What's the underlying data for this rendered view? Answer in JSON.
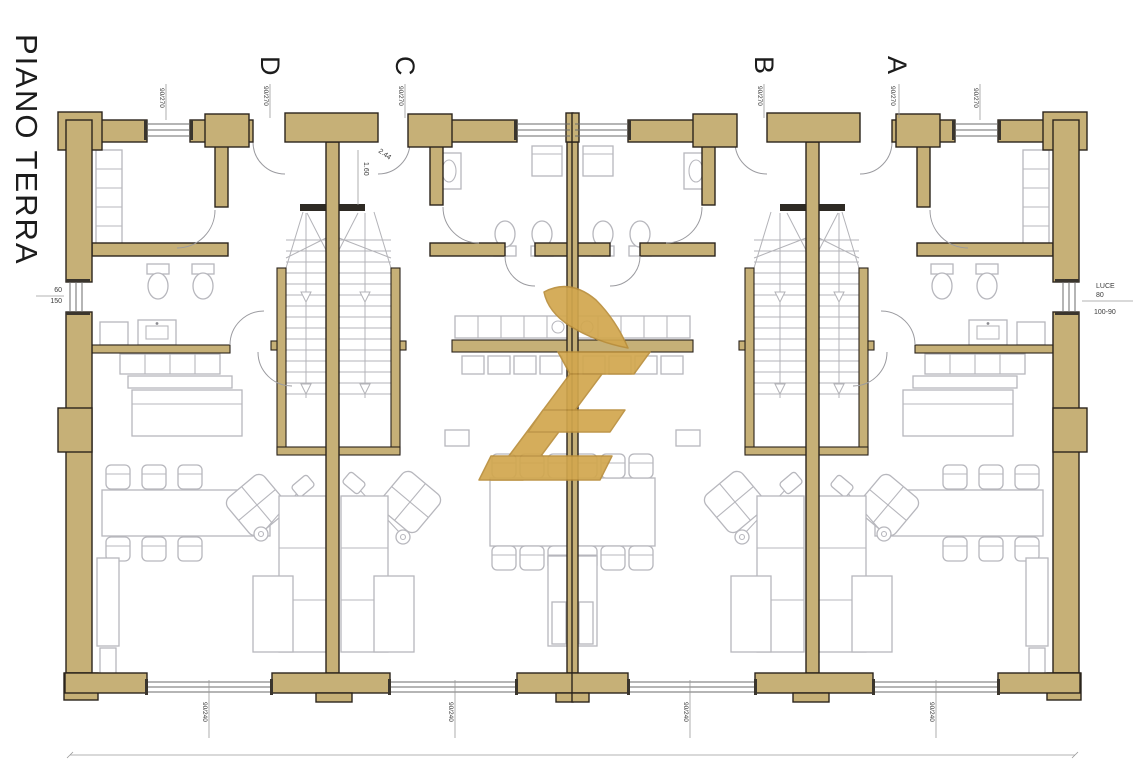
{
  "title": "PIANO TERRA",
  "plan": {
    "unit_labels": [
      {
        "id": "D",
        "label": "D",
        "dimension": "90/270"
      },
      {
        "id": "C",
        "label": "C",
        "dimension": "90/270"
      },
      {
        "id": "B",
        "label": "B",
        "dimension": "90/270"
      },
      {
        "id": "A",
        "label": "A",
        "dimension": "90/270"
      }
    ],
    "dimensions": {
      "left_window": {
        "width": "60",
        "height": "150"
      },
      "right_window": {
        "label": "LUCE",
        "width": "80",
        "size": "100-90"
      },
      "stair_width": "1.60",
      "stair_radius": "2.44",
      "top_windows": [
        "90/270",
        "90/270"
      ],
      "bottom_windows": [
        "90/240",
        "90/240",
        "90/240",
        "90/240"
      ]
    }
  },
  "watermark": {
    "name": "gold-letter-e-monogram",
    "glyph": "È"
  },
  "colors": {
    "wall": "#c6b077",
    "outline": "#2b241c",
    "furniture": "#b7b7bd",
    "stair": "#b3b3b8",
    "dim": "#9b9b9b",
    "text": "#3a3a3a",
    "window": "#6b6b6b",
    "gold": "#d2a74e",
    "gold_dark": "#b98e3b"
  }
}
